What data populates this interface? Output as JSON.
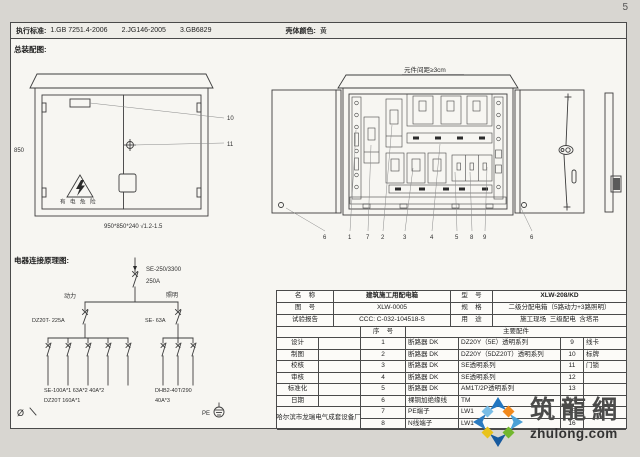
{
  "page": {
    "number": "5"
  },
  "header": {
    "standards_label": "执行标准:",
    "standard_1": "1.GB 7251.4-2006",
    "standard_2": "2.JG146-2005",
    "standard_3": "3.GB6829",
    "shell_color_label": "壳体颜色:",
    "shell_color_value": "黄"
  },
  "assembly_view": {
    "title": "总装配图:",
    "height_dim": "850",
    "warning_text": "有 电 危 险",
    "dimensions_note": "950*850*240 √1.2-1.5",
    "callout_plate": "10",
    "callout_handle": "11"
  },
  "internal_view": {
    "spacing_note": "元件间距≥3cm",
    "callouts": [
      "6",
      "1",
      "7",
      "2",
      "3",
      "4",
      "5",
      "8",
      "9",
      "6"
    ]
  },
  "schematic": {
    "title": "电器连接原理图:",
    "main_breaker_model": "SE-250/3300",
    "main_breaker_rating": "250A",
    "power_label": "动力",
    "lighting_label": "照明",
    "power_breaker": "DZ20T- 225A",
    "lighting_breaker": "SE- 63A",
    "power_branches_line1": "SE-100A*1   63A*2   40A*2",
    "power_branches_line2": "DZ20T 160A*1",
    "lighting_branches_line1": "DHB2-40T/290",
    "lighting_branches_line2": "40A*3",
    "phase_symbol": "Ø",
    "pe_label": "PE"
  },
  "spec_table": {
    "name_label": "名    称",
    "name_value": "建筑施工用配电箱",
    "model_label": "型    号",
    "model_value": "XLW-208/KD",
    "drawing_no_label": "图    号",
    "drawing_no_value": "XLW-0005",
    "spec_label": "规    格",
    "spec_value": "二级分配电箱（5路动力+3路照明）",
    "report_label": "试验报告",
    "report_value": "CCC: C-032-104518-S",
    "use_label": "用    途",
    "use_value": "施工现场  三级配电  含塔吊",
    "seq_header": "序    号",
    "parts_header": "主要配件",
    "role_labels": [
      "设计",
      "制图",
      "校核",
      "审核",
      "标准化",
      "日期"
    ],
    "rows": [
      {
        "no": "1",
        "item": "断路器 DK",
        "spec": "DZ20Y（5E）透明系列",
        "no2": "9",
        "item2": "线卡"
      },
      {
        "no": "2",
        "item": "断路器 DK",
        "spec": "DZ20Y（5DZ20T）透明系列",
        "no2": "10",
        "item2": "标牌"
      },
      {
        "no": "3",
        "item": "断路器 DK",
        "spec": "SE透明系列",
        "no2": "11",
        "item2": "门锁"
      },
      {
        "no": "4",
        "item": "断路器 DK",
        "spec": "SE透明系列",
        "no2": "12",
        "item2": ""
      },
      {
        "no": "5",
        "item": "断路器 DK",
        "spec": "AM1T/2P透明系列",
        "no2": "13",
        "item2": ""
      },
      {
        "no": "6",
        "item": "裸铜加绝缘线",
        "spec": "TM",
        "no2": "14",
        "item2": ""
      },
      {
        "no": "7",
        "item": "PE端子",
        "spec": "LW1",
        "no2": "15",
        "item2": ""
      },
      {
        "no": "8",
        "item": "N线端子",
        "spec": "LW1",
        "no2": "16",
        "item2": ""
      }
    ],
    "company": "哈尔滨市龙瑞电气成套设备厂"
  },
  "logo": {
    "name": "筑龍網",
    "domain": "zhulong.com",
    "colors": {
      "blue": "#2176c0",
      "dark_blue": "#175a9e",
      "light_blue": "#79bde6",
      "orange": "#f2891c",
      "green": "#72b72e",
      "yellow": "#e9c31c"
    }
  }
}
